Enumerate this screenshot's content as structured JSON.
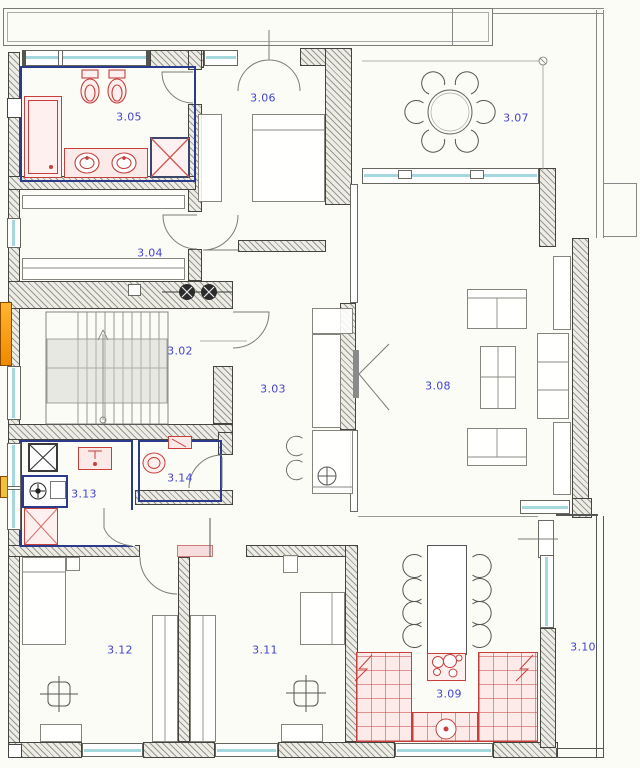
{
  "plan": {
    "rooms": [
      {
        "label": "3.02"
      },
      {
        "label": "3.03"
      },
      {
        "label": "3.04"
      },
      {
        "label": "3.05"
      },
      {
        "label": "3.06"
      },
      {
        "label": "3.07"
      },
      {
        "label": "3.08"
      },
      {
        "label": "3.09"
      },
      {
        "label": "3.10"
      },
      {
        "label": "3.11"
      },
      {
        "label": "3.12"
      },
      {
        "label": "3.13"
      },
      {
        "label": "3.14"
      }
    ]
  },
  "colors": {
    "room_label_blue": "#4343d0",
    "fixture_red": "#c5403d",
    "partition_blue": "#2c3a8c",
    "window_glass_teal": "#a5d8dc",
    "wall_hatch_gray": "#97978f",
    "highlight_orange": "#ef8a00"
  }
}
